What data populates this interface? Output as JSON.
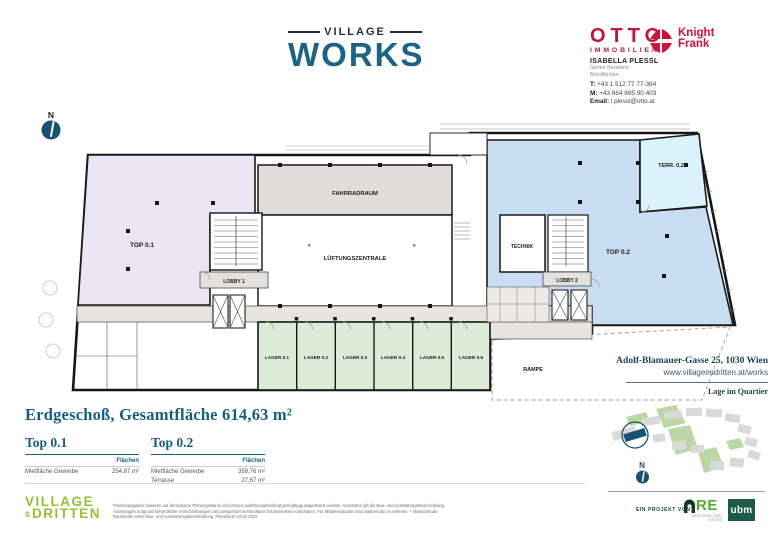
{
  "brand": {
    "village": "VILLAGE",
    "works": "WORKS"
  },
  "broker": {
    "otto": "OTTO",
    "otto_sub": "IMMOBILIEN",
    "kf_line1": "Knight",
    "kf_line2": "Frank",
    "name": "ISABELLA PLESSL",
    "role1": "Senior Beraterin",
    "role2": "Büroflächen",
    "phone_label": "T:",
    "phone": "+43 1 512 77 77-364",
    "mobile_label": "M:",
    "mobile": "+43 664 885 90 403",
    "email_label": "Email:",
    "email": "i.plessl@otto.at"
  },
  "plan": {
    "north": "N",
    "rooms": {
      "top01": "TOP 0.1",
      "top02": "TOP 0.2",
      "terr": "TERR. 0.2",
      "fahrradraum": "FAHRRADRAUM",
      "lueftung": "LÜFTUNGSZENTRALE",
      "technik": "TECHNIK",
      "lobby1": "LOBBY 1",
      "lobby2": "LOBBY 2",
      "lager": [
        "LAGER 0.1",
        "LAGER 0.2",
        "LAGER 0.3",
        "LAGER 0.4",
        "LAGER 0.5",
        "LAGER 0.6"
      ],
      "rampe": "RAMPE"
    }
  },
  "address": {
    "street": "Adolf-Blamauer-Gasse 25, 1030 Wien",
    "web": "www.villageimdritten.at/works",
    "map_title": "Lage im Quartier",
    "north": "N"
  },
  "summary": {
    "title": "Erdgeschoß, Gesamtfläche 614,63 m²",
    "units": [
      {
        "name": "Top 0.1",
        "col_header": "Flächen",
        "rows": [
          {
            "label": "Mietfläche Gewerbe",
            "value": "254,87 m²"
          }
        ]
      },
      {
        "name": "Top 0.2",
        "col_header": "Flächen",
        "rows": [
          {
            "label": "Mietfläche Gewerbe",
            "value": "359,76 m²"
          },
          {
            "label": "Terrasse",
            "value": "27,67 m²"
          }
        ]
      }
    ]
  },
  "footer": {
    "village": "VILLAGE",
    "im": "IM",
    "dritten": "DRITTEN",
    "disclaimer": "Flächenangaben basieren auf derzeitigem Planungsstand und können ausführungsbedingt geringfügig abgeändert werden. Ansonsten gilt die Bau- und Ausstattungsbeschreibung. Änderungen aufgrund behördlicher Vorschreibungen und zwingender konstruktiver Erfordernisse vorbehalten. Für Möbeleinbauten sind Naturmaße zu nehmen. * Abweichende Raumhöhe siehe Bau- und Ausstattungsbeschreibung. Planstand: 03.02.2022",
    "project_label": "EIN PROJEKT VON",
    "are": "RE",
    "are_sub": "AUSTRIAN REAL ESTATE",
    "ubm": "ubm"
  },
  "colors": {
    "teal_brand": "#1d6484",
    "teal_heading": "#175d7d",
    "crimson_otto": "#c01638",
    "crimson_kf": "#d0113e",
    "room_top01": "#e9e5f3",
    "room_top02": "#c8ddf2",
    "room_terrace": "#daf2fa",
    "room_lager": "#dcebd8",
    "room_gray": "#dfddd8",
    "corridor": "#e6e4df",
    "navy_compass": "#17536f",
    "green_vid": "#94bf36",
    "green_ubm": "#1d5b49"
  }
}
